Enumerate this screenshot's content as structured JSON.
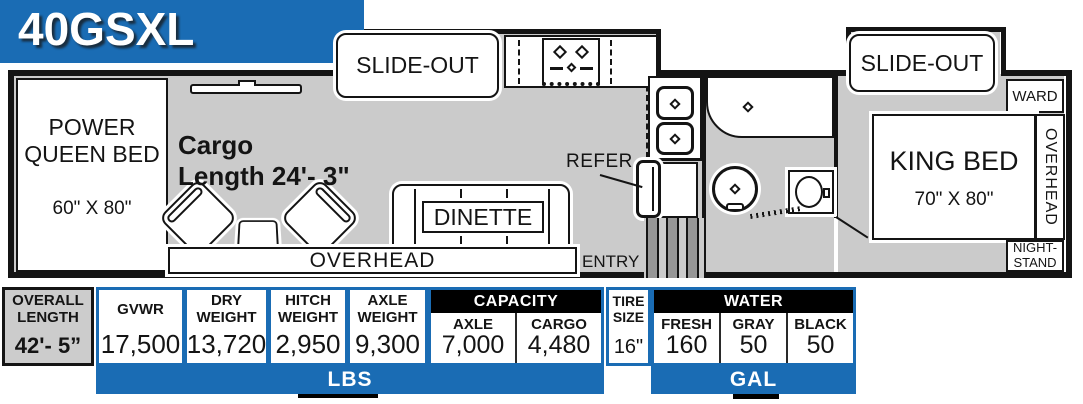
{
  "banner": {
    "model": "40GSXL"
  },
  "plan": {
    "queen_bed": {
      "line1": "POWER",
      "line2": "QUEEN BED",
      "size": "60\" X 80\""
    },
    "cargo": {
      "line1": "Cargo",
      "line2": "Length 24'- 3\""
    },
    "slide_out_front": "SLIDE-OUT",
    "slide_out_bedroom": "SLIDE-OUT",
    "dinette": "DINETTE",
    "overhead_garage": "OVERHEAD",
    "refer": "REFER",
    "entry": "ENTRY",
    "king_bed": {
      "name": "KING BED",
      "size": "70\" X 80\""
    },
    "ward": "WARD",
    "overhead_bedroom": "OVERHEAD",
    "nightstand": {
      "line1": "NIGHT-",
      "line2": "STAND"
    }
  },
  "specs": {
    "overall": {
      "line1": "OVERALL",
      "line2": "LENGTH",
      "value": "42'- 5”"
    },
    "weights": [
      {
        "label1": "GVWR",
        "label2": "",
        "value": "17,500"
      },
      {
        "label1": "DRY",
        "label2": "WEIGHT",
        "value": "13,720"
      },
      {
        "label1": "HITCH",
        "label2": "WEIGHT",
        "value": "2,950"
      },
      {
        "label1": "AXLE",
        "label2": "WEIGHT",
        "value": "9,300"
      }
    ],
    "capacity": {
      "header": "CAPACITY",
      "cells": [
        {
          "label": "AXLE",
          "value": "7,000"
        },
        {
          "label": "CARGO",
          "value": "4,480"
        }
      ]
    },
    "tire": {
      "line1": "TIRE",
      "line2": "SIZE",
      "value": "16\""
    },
    "water": {
      "header": "WATER",
      "cells": [
        {
          "label": "FRESH",
          "value": "160"
        },
        {
          "label": "GRAY",
          "value": "50"
        },
        {
          "label": "BLACK",
          "value": "50"
        }
      ]
    },
    "unit_lbs": "LBS",
    "unit_gal": "GAL"
  },
  "colors": {
    "accent_blue": "#1a6cb4",
    "floor_gray": "#cbcbcb",
    "wall_black": "#141414"
  }
}
